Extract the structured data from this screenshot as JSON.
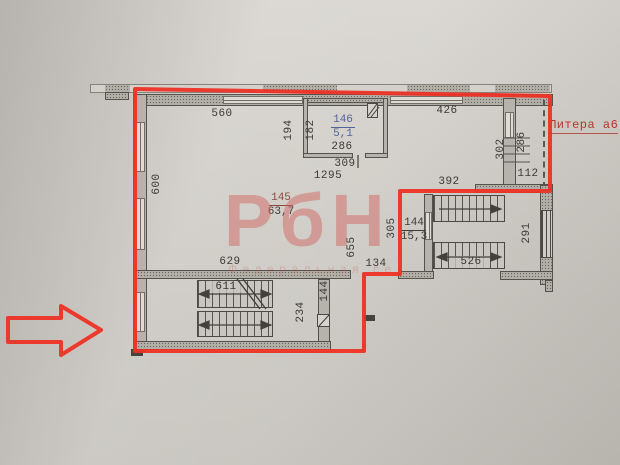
{
  "plan": {
    "litera": "Литера а6",
    "watermark_big": "РбН",
    "watermark_sub": "Федеральная се",
    "rooms": {
      "r146": {
        "num": "146",
        "area": "5,1"
      },
      "r145": {
        "num": "145",
        "area": "63,7"
      },
      "r144": {
        "num": "144",
        "area": "15,3"
      }
    },
    "dims": {
      "d560": "560",
      "d426": "426",
      "d600": "600",
      "d194": "194",
      "d182": "182",
      "d286a": "286",
      "d309": "309",
      "d1295": "1295",
      "d302": "302",
      "d286b": "286",
      "d112": "112",
      "d392": "392",
      "d291": "291",
      "d305": "305",
      "d655": "655",
      "d134": "134",
      "d629": "629",
      "d611": "611",
      "d526": "526",
      "d234": "234",
      "d144": "144"
    },
    "colors": {
      "outline": "#ee3126",
      "room146_label": "#55639b",
      "room145_label": "#8c4b40",
      "watermark": "#d06260"
    }
  }
}
